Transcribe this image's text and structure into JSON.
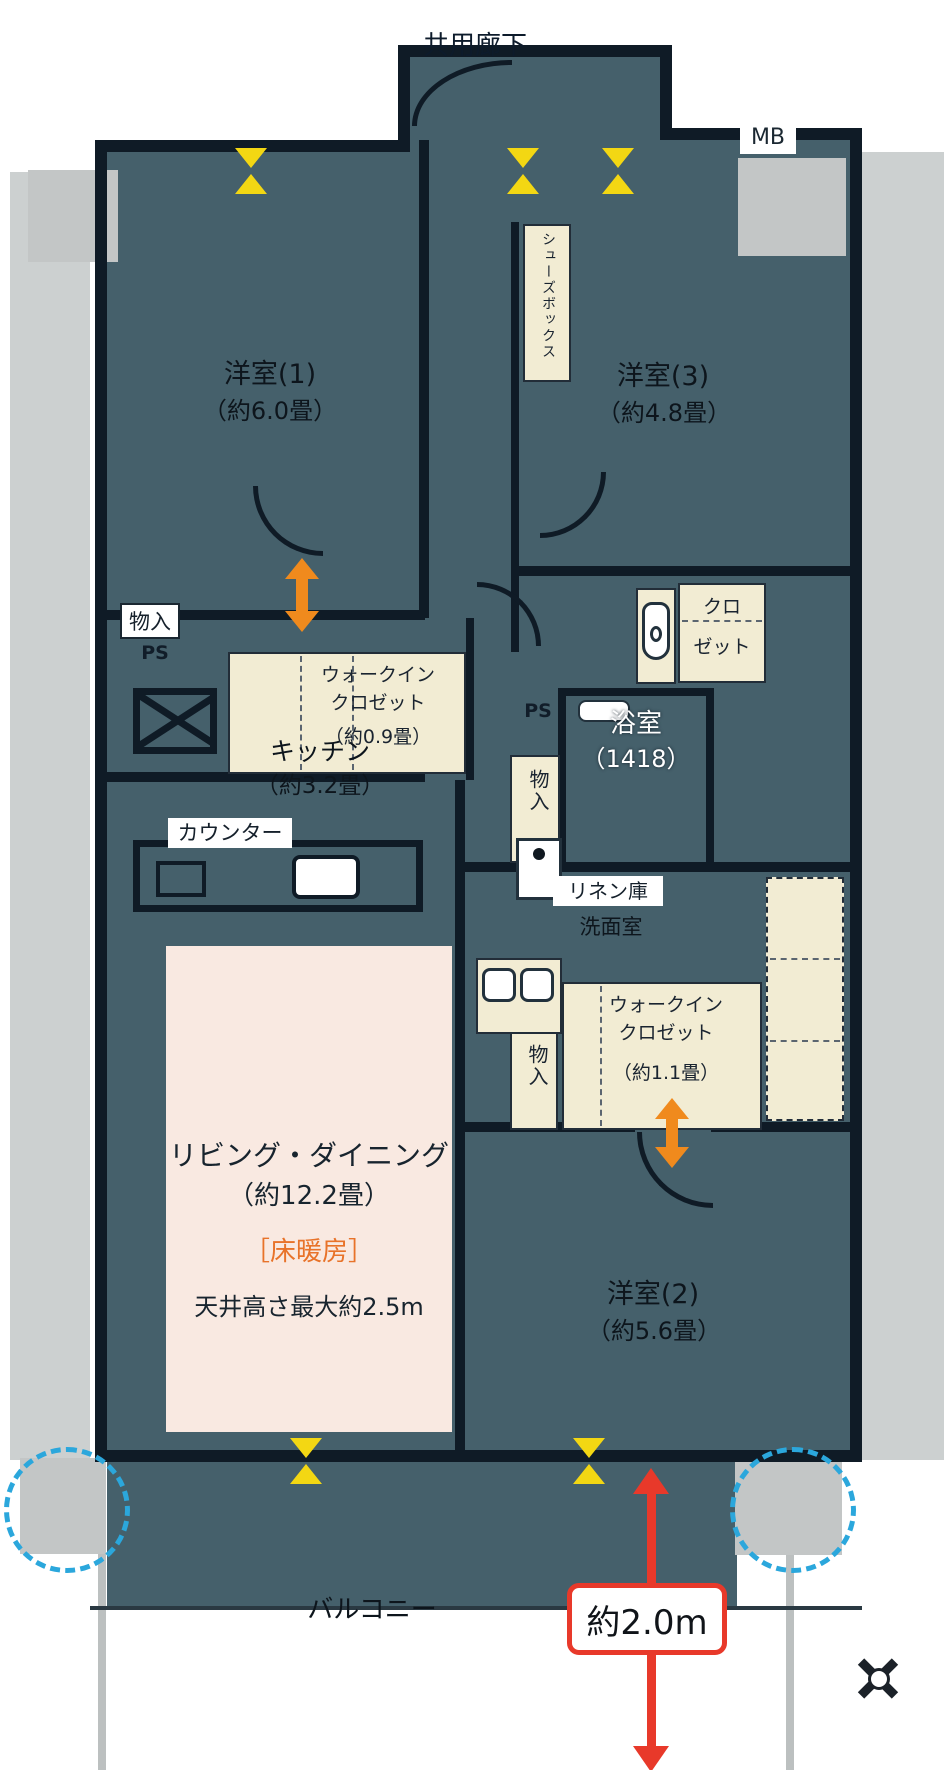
{
  "colors": {
    "floor": "#45606b",
    "wall": "#0f1b26",
    "cream": "#f2ecd3",
    "pink": "#f9e9e1",
    "gray": "#ccd0d0",
    "orange": "#f08a1d",
    "red": "#e8392a",
    "blue": "#2ba7dc",
    "yellow": "#f3d713"
  },
  "labels": {
    "corridor": "共用廊下",
    "mb": "MB",
    "counter": "カウンター",
    "ps": "PS",
    "dim_width": "約2.0m",
    "balcony": "バルコニー"
  },
  "rooms": {
    "room1": {
      "name": "洋室(1)",
      "size": "（約6.0畳）"
    },
    "room2": {
      "name": "洋室(2)",
      "size": "（約5.6畳）"
    },
    "room3": {
      "name": "洋室(3)",
      "size": "（約4.8畳）"
    },
    "kitchen": {
      "name": "キッチン",
      "size": "（約3.2畳）"
    },
    "living": {
      "name": "リビング・ダイニング",
      "size": "（約12.2畳）",
      "floor_heating": "［床暖房］",
      "ceiling": "天井高さ最大約2.5m"
    },
    "bath": {
      "name": "浴室",
      "size": "（1418）"
    },
    "washroom": {
      "name": "洗面室"
    }
  },
  "storage": {
    "shoes_box": "シューズボックス",
    "wic_small": {
      "line1": "ウォークイン",
      "line2": "クロゼット",
      "size": "（約0.9畳）"
    },
    "wic_large": {
      "line1": "ウォークイン",
      "line2": "クロゼット",
      "size": "（約1.1畳）"
    },
    "closet": {
      "line1": "クロ",
      "line2": "ゼット"
    },
    "monoire": "物入",
    "linen": "リネン庫"
  }
}
